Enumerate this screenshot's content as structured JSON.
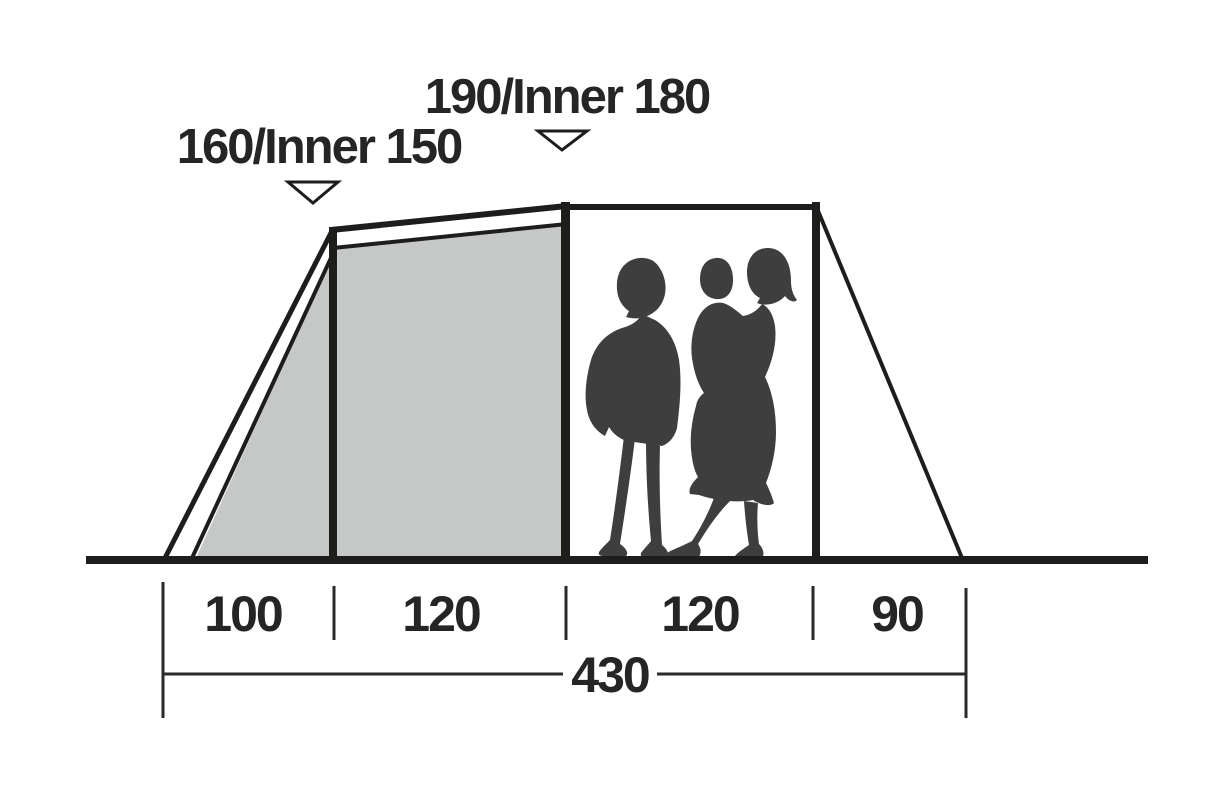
{
  "diagram": {
    "kind": "tent-side-profile-dimension-diagram",
    "height_labels": [
      {
        "text": "160/Inner 150",
        "outer_height": 160,
        "inner_height": 150
      },
      {
        "text": "190/Inner 180",
        "outer_height": 190,
        "inner_height": 180
      }
    ],
    "width_segments": [
      {
        "label": "100",
        "value": 100
      },
      {
        "label": "120",
        "value": 120
      },
      {
        "label": "120",
        "value": 120
      },
      {
        "label": "90",
        "value": 90
      }
    ],
    "total_width": {
      "label": "430",
      "value": 430
    },
    "icons": {
      "height_marker": "down-triangle-marker"
    },
    "figures": "two-adults-one-child-silhouette",
    "colors": {
      "line": "#1d1d1b",
      "inner_panel_fill": "#c6c8c8",
      "silhouette": "#3e3e3e",
      "text": "#252525",
      "background": "#ffffff"
    }
  }
}
